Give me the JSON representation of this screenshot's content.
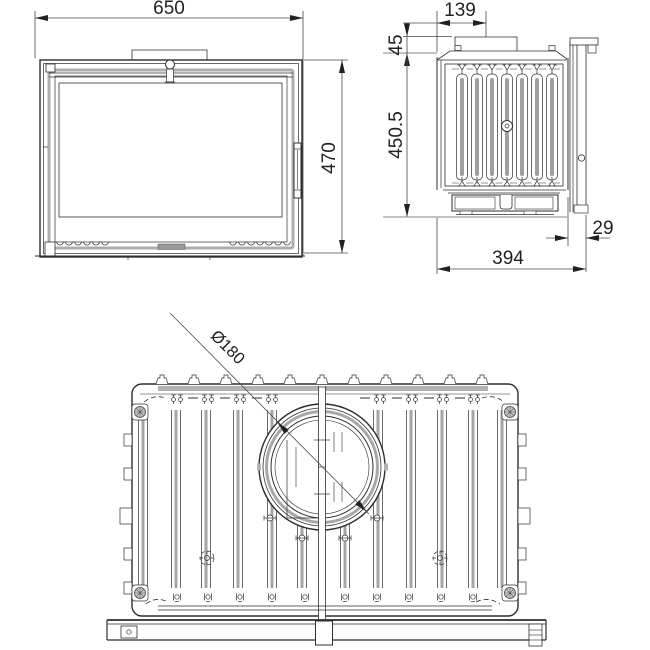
{
  "views": {
    "front": {
      "dim_width": "650",
      "dim_height": "470"
    },
    "side": {
      "dim_flue_center": "139",
      "dim_collar": "45",
      "dim_height": "450.5",
      "dim_depth": "394",
      "dim_rear": "29"
    },
    "top": {
      "dim_flue_diameter": "Ø180"
    }
  },
  "colors": {
    "line": "#2e2e2e",
    "dimension_text": "#231f20",
    "gray_fill": "#b3b3b3",
    "background": "#ffffff"
  }
}
